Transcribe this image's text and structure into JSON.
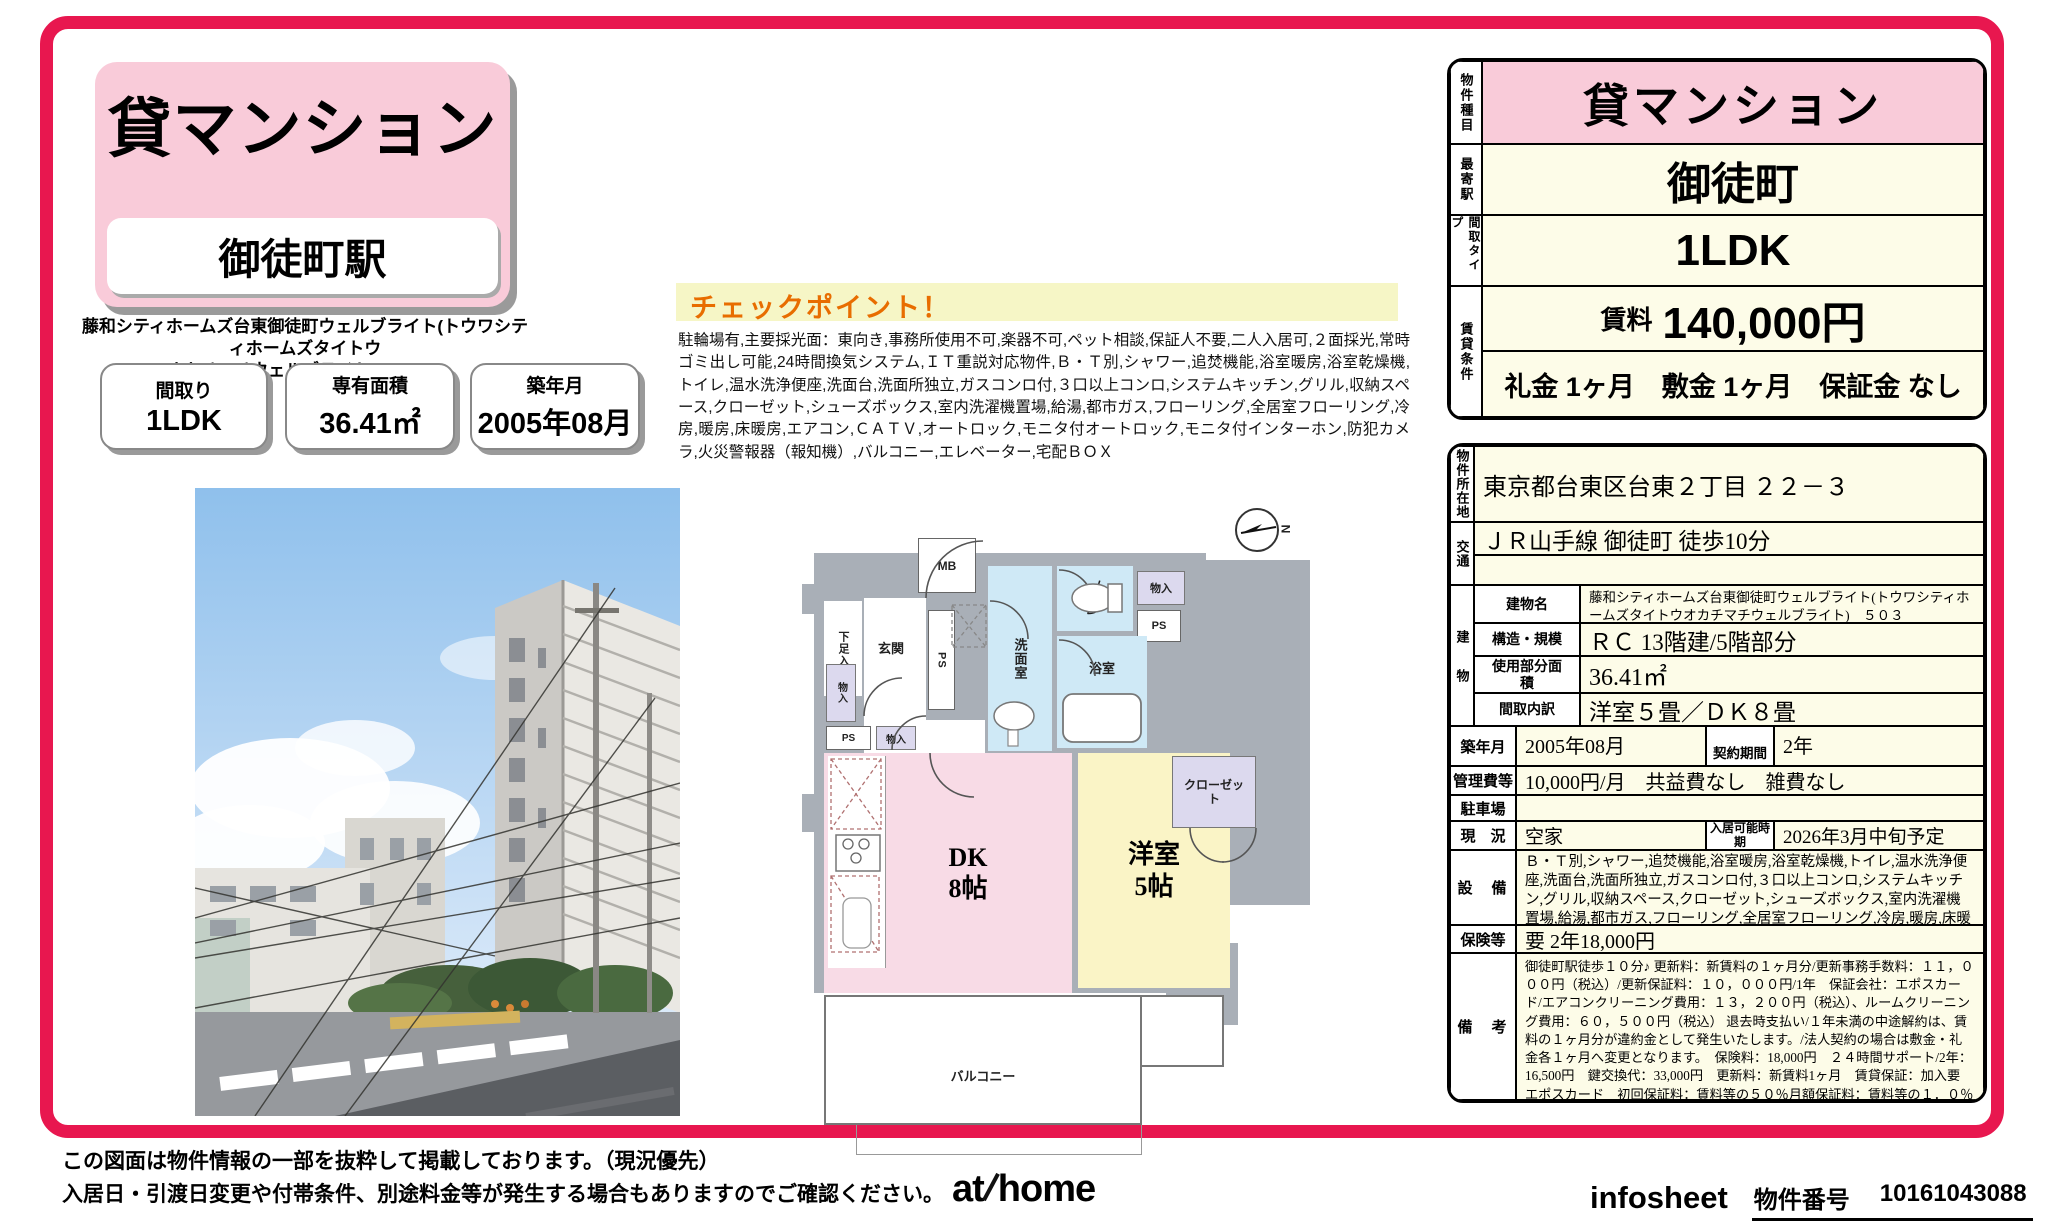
{
  "header": {
    "property_type": "貸マンション",
    "station": "御徒町駅",
    "property_name_line1": "藤和シティホームズ台東御徒町ウェルブライト(トウワシティホームズタイトウ",
    "property_name_line2": "オカチマチウェルブライト)　５０３",
    "info_boxes": [
      {
        "label": "間取り",
        "value": "1LDK"
      },
      {
        "label": "専有面積",
        "value": "36.41㎡"
      },
      {
        "label": "築年月",
        "value": "2005年08月"
      }
    ]
  },
  "checkpoint": {
    "title": "チェックポイント！",
    "body": "駐輪場有,主要採光面：東向き,事務所使用不可,楽器不可,ペット相談,保証人不要,二人入居可,２面採光,常時ゴミ出し可能,24時間換気システム,ＩＴ重説対応物件,Ｂ・Ｔ別,シャワー,追焚機能,浴室暖房,浴室乾燥機,トイレ,温水洗浄便座,洗面台,洗面所独立,ガスコンロ付,３口以上コンロ,システムキッチン,グリル,収納スペース,クローゼット,シューズボックス,室内洗濯機置場,給湯,都市ガス,フローリング,全居室フローリング,冷房,暖房,床暖房,エアコン,ＣＡＴＶ,オートロック,モニタ付オートロック,モニタ付インターホン,防犯カメラ,火災警報器（報知機）,バルコニー,エレベーター,宅配ＢＯＸ"
  },
  "summary_table": {
    "property_type_label": "物件種目",
    "property_type": "貸マンション",
    "station_label": "最寄駅",
    "station": "御徒町",
    "layout_label": "間取タイプ",
    "layout": "1LDK",
    "terms_label": "賃貸条件",
    "rent_label": "賃料",
    "rent": "140,000円",
    "fees": "礼金 1ヶ月　敷金 1ヶ月　保証金 なし"
  },
  "detail_table": {
    "address_label": "物件所在地",
    "address": "東京都台東区台東２丁目 ２２－３",
    "access_label": "交通",
    "access": "ＪＲ山手線 御徒町 徒歩10分",
    "access2": "",
    "building_label": "建物",
    "building_name_label": "建物名",
    "building_name": "藤和シティホームズ台東御徒町ウェルブライト(トウワシティホームズタイトウオカチマチウェルブライト)　５０３",
    "structure_label": "構造・規模",
    "structure": "ＲＣ 13階建/5階部分",
    "area_label": "使用部分面積",
    "area": "36.41㎡",
    "layout_detail_label": "間取内訳",
    "layout_detail": "洋室５畳／ＤＫ８畳",
    "built_label": "築年月",
    "built": "2005年08月",
    "contract_label": "契約期間",
    "contract": "2年",
    "mgmt_label": "管理費等",
    "mgmt": "10,000円/月　共益費なし　雑費なし",
    "parking_label": "駐車場",
    "parking": "",
    "status_label": "現　況",
    "status": "空家",
    "movein_label": "入居可能時期",
    "movein": "2026年3月中旬予定",
    "equipment_label": "設　備",
    "equipment": "Ｂ・Ｔ別,シャワー,追焚機能,浴室暖房,浴室乾燥機,トイレ,温水洗浄便座,洗面台,洗面所独立,ガスコンロ付,３口以上コンロ,システムキッチン,グリル,収納スペース,クローゼット,シューズボックス,室内洗濯機置場,給湯,都市ガス,フローリング,全居室フローリング,冷房,暖房,床暖房,エア...",
    "insurance_label": "保険等",
    "insurance": "要 2年18,000円",
    "notes_label": "備　考",
    "notes": "御徒町駅徒歩１０分♪ 更新料：新賃料の１ヶ月分/更新事務手数料：１１，０００円（税込）/更新保証料：１０，０００円/1年　保証会社：エポスカード/エアコンクリーニング費用：１３，２００円（税込）、ルームクリーニング費用：６０，５００円（税込） 退去時支払い/１年未満の中途解約は、賃料の１ヶ月分が違約金として発生いたします。/法人契約の場合は敷金・礼金各１ヶ月へ変更となります。　保険料：18,000円　２４時間サポート/2年：16,500円　鍵交換代：33,000円　更新料：新賃料1ヶ月　賃貸保証：加入要 エポスカード　初回保証料：賃料等の５０％月額保証料：賃料等の１．０％更新保証料：１０，０００円/1年　利用駅１：都営大江戸線 新御徒町 徒歩8分　利用駅２：ＪＲ京浜東北・根岸線 秋葉原 徒歩12分"
  },
  "floor_plan": {
    "labels": {
      "mb": "MB",
      "shoe": "下足入",
      "entrance": "玄関",
      "ps": "PS",
      "wash": "洗面室",
      "toilet": "トイレ",
      "storage": "物入",
      "bath": "浴室",
      "hall": "廊下",
      "closet": "クローゼット",
      "dk": "DK",
      "dk_size": "8帖",
      "western": "洋室",
      "western_size": "5帖",
      "balcony": "バルコニー",
      "north": "N"
    }
  },
  "footer": {
    "note1": "この図面は物件情報の一部を抜粋して掲載しております。（現況優先）",
    "note2": "入居日・引渡日変更や付帯条件、別途料金等が発生する場合もありますのでご確認ください。",
    "logo_at": "at",
    "logo_home": "home",
    "infosheet": "infosheet",
    "property_no_label": "物件番号",
    "property_no": "10161043088"
  },
  "colors": {
    "frame": "#e8174f",
    "header_pink": "#f9cbd9",
    "table_cream": "#fdfce8",
    "checkpoint_band": "#f6f6c6",
    "checkpoint_title": "#e86d00",
    "plan_wall_gray": "#a9afb7",
    "plan_blue": "#cfe9f6",
    "plan_lavender": "#dcd9ee",
    "plan_pink": "#f8dbe6",
    "plan_yellow": "#faf4c6"
  }
}
